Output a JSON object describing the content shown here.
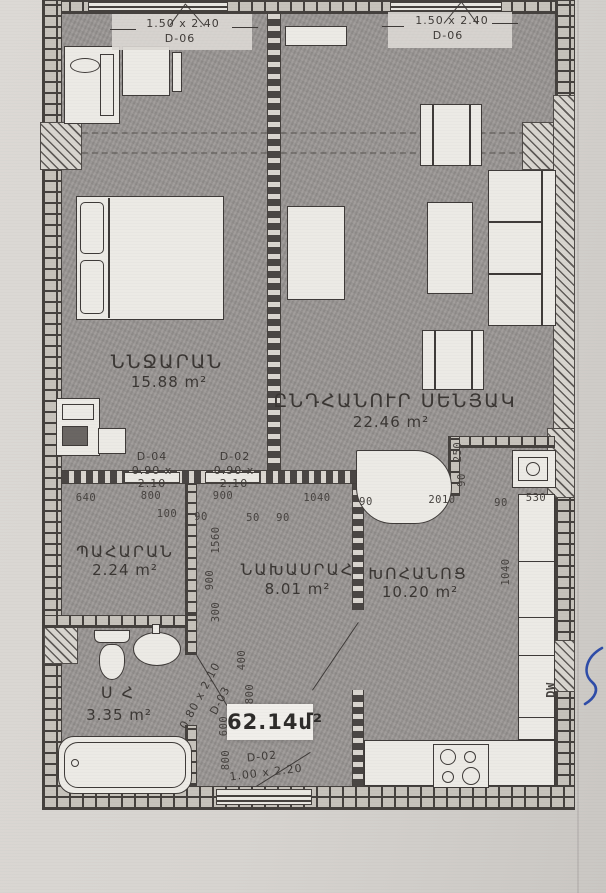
{
  "title": "apartment-floor-plan-scan",
  "total_area": "62.14մ²",
  "rooms": {
    "bedroom": {
      "name": "ՆՆՋԱՐԱՆ",
      "area": "15.88 m²"
    },
    "living": {
      "name": "ԸՆԴՀԱՆՈՒՐ ՍԵՆՅԱԿ",
      "area": "22.46 m²"
    },
    "closet": {
      "name": "ՊԱՀԱՐԱՆ",
      "area": "2.24 m²"
    },
    "hallway": {
      "name": "ՆԱԽԱՍՐԱՀ",
      "area": "8.01 m²"
    },
    "kitchen": {
      "name": "ԽՈՀԱՆՈՑ",
      "area": "10.20 m²"
    },
    "bathroom": {
      "name": "Ս Հ",
      "area": "3.35 m²"
    }
  },
  "openings": {
    "window_bedroom": {
      "size": "1.50 x 2.40",
      "code": "D-06"
    },
    "window_living": {
      "size": "1.50 x 2.40",
      "code": "D-06"
    },
    "door_closet": {
      "code": "D-04",
      "size": "0.90 x 2.10"
    },
    "door_hallway": {
      "code": "D-02",
      "size": "0.90 x 2.10"
    },
    "door_bathroom": {
      "code": "D-03",
      "size": "0.80 x 2.10"
    },
    "door_balcony": {
      "code": "D-02",
      "size": "1.00 x 2.20"
    }
  },
  "appliances": {
    "dishwasher": "DW"
  },
  "dims": {
    "h": [
      "640",
      "800",
      "100",
      "900",
      "90",
      "50",
      "90",
      "1040",
      "90",
      "2010",
      "90",
      "530"
    ],
    "v": [
      "1560",
      "900",
      "300",
      "250",
      "90",
      "1040",
      "400",
      "800",
      "600",
      "800"
    ]
  },
  "colors": {
    "paper": "#d7d4d0",
    "floor": "#9a9694",
    "wall": "#45413e",
    "furniture": "#eceae5",
    "ink_blue": "#2f4da8"
  }
}
